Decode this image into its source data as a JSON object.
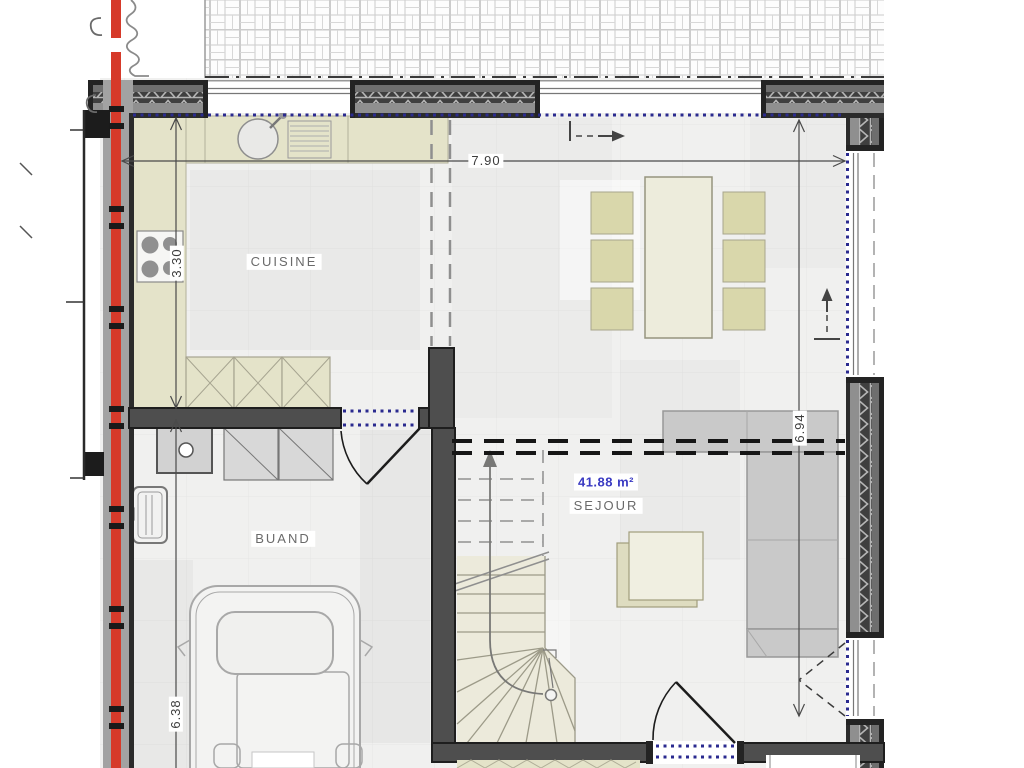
{
  "labels": {
    "kitchen": "CUISINE",
    "laundry": "BUAND",
    "living": "SEJOUR",
    "living_area": "41.88 m²"
  },
  "dimensions": {
    "width": "7.90",
    "kitchen_depth": "3.30",
    "living_depth": "6.94",
    "garage_depth": "6.38"
  },
  "colors": {
    "wall_dark": "#232323",
    "wall_core": "#4e4e4e",
    "wall_inner_band": "#8f8f8f",
    "boundary_red": "#d63a2a",
    "sill_blue": "#2a2a8f",
    "counter_beige": "#e4e3c9",
    "stair_beige": "#eceadb",
    "furniture_gray": "#c9c9c9",
    "floor": "#f0f0ef",
    "area_text_blue": "#3a3ac2"
  }
}
